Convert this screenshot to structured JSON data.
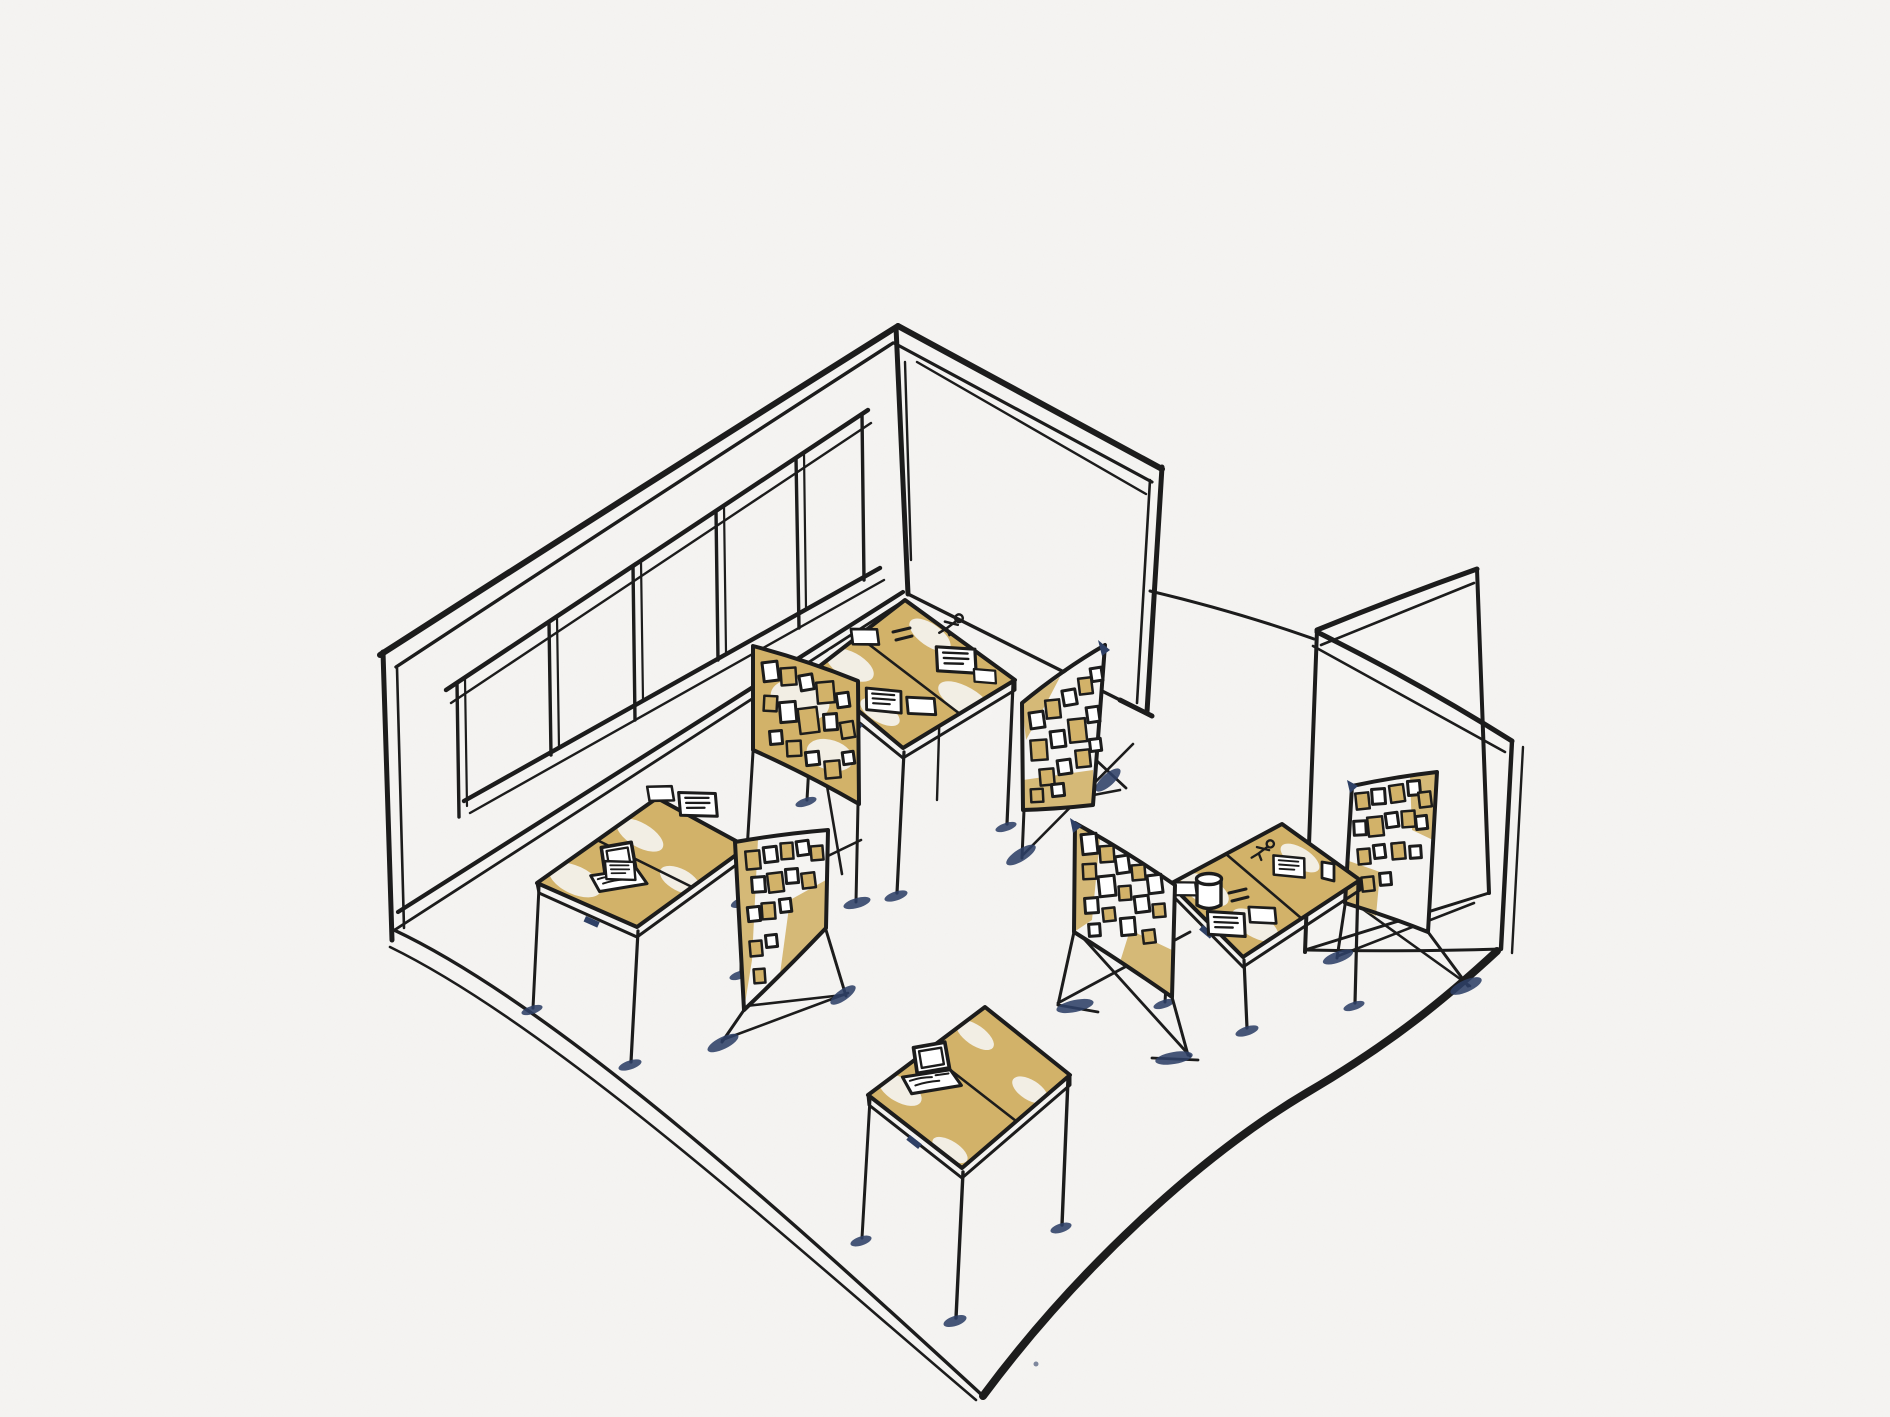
{
  "meta": {
    "description": "Hand-drawn isometric ink-and-watercolor sketch of an empty workshop room with tables, laptops and pin boards covered in sticky notes",
    "style": "black ink line sketch with tan watercolor wash on white paper"
  },
  "palette": {
    "paper": "#f5f4f2",
    "ink": "#1c1c1c",
    "tan": "#d2b269",
    "tan_light": "#e4cf99",
    "navy": "#2e4066",
    "white": "#ffffff"
  },
  "room": {
    "left_wall": {
      "name": "left wall",
      "window_panes": 5
    },
    "back_wall": {
      "name": "back wall",
      "window_panes": 0
    },
    "partition": {
      "name": "free-standing corner partition",
      "panels": 2
    },
    "floor": {
      "name": "floor",
      "shape": "diamond"
    }
  },
  "furniture": {
    "tables": [
      {
        "id": "back-table",
        "items": [
          "running-figure sketch",
          "paper with notes",
          "papers",
          "blank card"
        ]
      },
      {
        "id": "left-table",
        "items": [
          "open laptop",
          "paper with notes",
          "blank card",
          "small note"
        ]
      },
      {
        "id": "right-table",
        "items": [
          "mug",
          "running-figure sketch",
          "paper with notes",
          "blank card",
          "small cup",
          "note sheet"
        ]
      },
      {
        "id": "front-table",
        "items": [
          "open laptop"
        ]
      }
    ],
    "pinboards": [
      {
        "id": "pinboard-back-left",
        "sticky_notes": 15
      },
      {
        "id": "pinboard-back-right",
        "sticky_notes": 15
      },
      {
        "id": "pinboard-front-left",
        "sticky_notes": 15
      },
      {
        "id": "pinboard-front-right",
        "sticky_notes": 15
      },
      {
        "id": "pinboard-far-right",
        "sticky_notes": 16
      }
    ]
  }
}
